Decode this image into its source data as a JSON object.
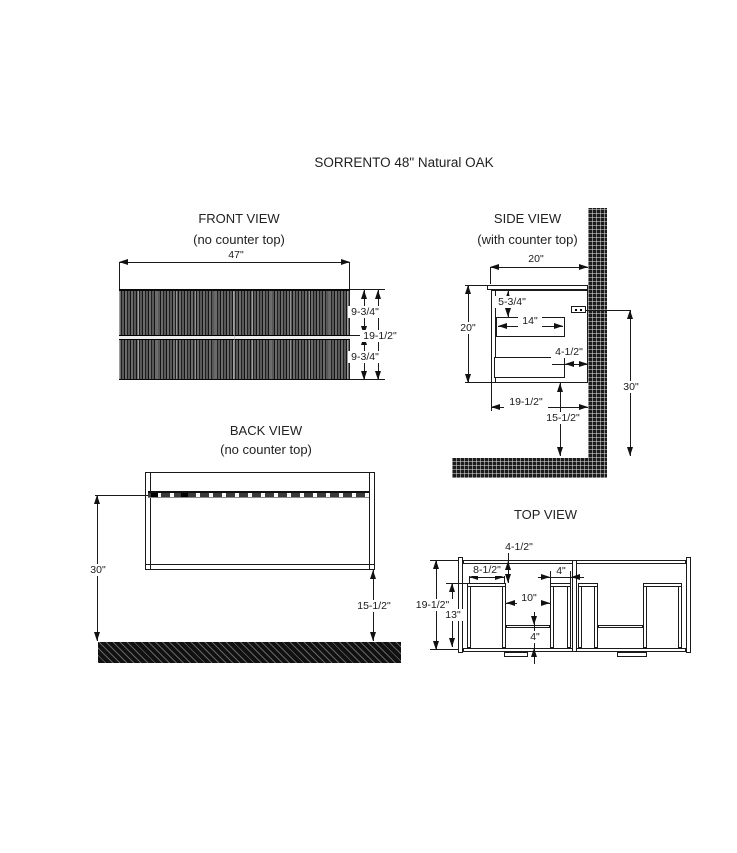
{
  "title": "SORRENTO 48\" Natural OAK",
  "views": {
    "front": {
      "title": "FRONT VIEW",
      "subtitle": "(no counter top)",
      "dims": {
        "width": "47\"",
        "upper_drawer": "9-3/4\"",
        "total_height": "19-1/2\"",
        "lower_drawer": "9-3/4\""
      }
    },
    "side": {
      "title": "SIDE VIEW",
      "subtitle": "(with counter top)",
      "dims": {
        "top_depth": "20\"",
        "counter_to_drawer": "5-3/4\"",
        "drawer_depth": "14\"",
        "height": "20\"",
        "wall_gap": "4-1/2\"",
        "bottom_depth": "19-1/2\"",
        "floor_clearance": "15-1/2\"",
        "mount_height": "30\""
      }
    },
    "back": {
      "title": "BACK VIEW",
      "subtitle": "(no counter top)",
      "dims": {
        "mount_height": "30\"",
        "floor_clearance": "15-1/2\""
      }
    },
    "top": {
      "title": "TOP VIEW",
      "dims": {
        "back_inset": "4-1/2\"",
        "side_bay_width": "8-1/2\"",
        "center_bay_width": "4\"",
        "middle_width": "10\"",
        "total_depth": "19-1/2\"",
        "bay_depth": "13\"",
        "shelf_depth": "4\""
      }
    }
  }
}
